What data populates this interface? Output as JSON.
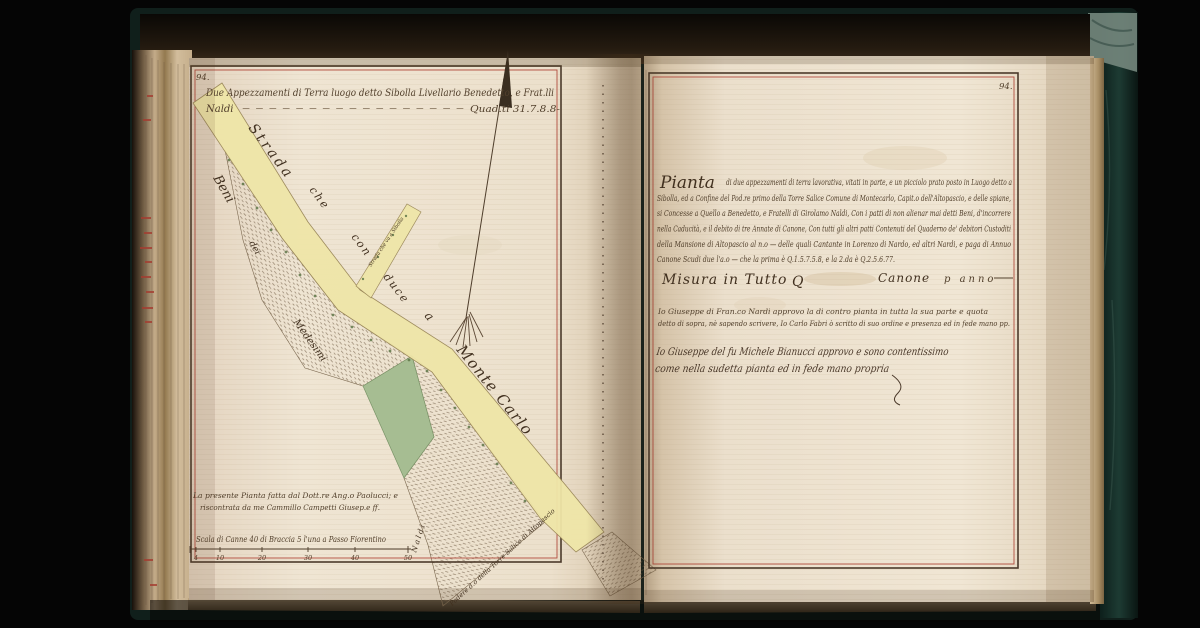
{
  "left_page": {
    "page_number": "94.",
    "header_line1": "Due Appezzamenti di Terra luogo detto Sibolla Livellario Benedetto, e Frat.lli",
    "header_naldi": "Naldi",
    "header_dashes": "– – – – – – – – – – – – – – – – –",
    "header_quantity": "Quad.ti 31.7.8.8-",
    "map": {
      "road_words": [
        "Strada",
        "che",
        "con",
        "duce",
        "a",
        "Monte Carlo"
      ],
      "spur_label": "Strada che va a Sibolla",
      "parcel_words": [
        "Beni",
        "dei",
        "Medesimi"
      ],
      "side_owner_label": "Naldi",
      "podere_label": "Podere d.o della Torre Salice di Altopascio",
      "credit_line1": "La presente Pianta fatta dal Dott.re Ang.o Paolucci; e",
      "credit_line2": "riscontrata da me Cammillo Campetti Giusep.e ff.",
      "scale_caption": "Scala di Canne 40 di Braccia 5 l'una a Passo Fiorentino",
      "scale_ticks": [
        "4",
        "10",
        "20",
        "30",
        "40",
        "50"
      ]
    }
  },
  "right_page": {
    "page_number": "94.",
    "lead_word": "Pianta",
    "line1_rest": "di due appezzamenti di terra lavorativa, vitati in parte, e un picciolo prato posto in Luogo detto a",
    "line2": "Sibolla, ed a Confine del Pod.re primo della Torre Salice Comune di Montecarlo, Capit.o dell'Altopascio, e delle spiane,",
    "line3": "si Concesse a Quello a Benedetto, e Fratelli di Girolamo Naldi, Con i patti di non alienar mai detti Beni, d'incorrere",
    "line4": "nella Caducità, e il debito di tre Annate di Canone, Con tutti gli altri patti Contenuti del Quaderno de' debitori Custoditi",
    "line5": "della Mansione di Altopascio al n.o — delle quali Cantante in Lorenzo di Nardo, ed altri Nardi, e paga di Annuo",
    "line6": "Canone Scudi due l'a.o — che la prima è Q.1.5.7.5.8, e la 2.da è Q.2.5.6.77.",
    "misura_label": "Misura in Tutto",
    "misura_q": "Q",
    "canone_label": "Canone",
    "canone_suffix": "p anno",
    "attest1_line1": "Io Giuseppe di Fran.co Nardi approvo la di contro pianta in tutta la sua parte e quota",
    "attest1_line2": "detto di sopra, nè sapendo scrivere, Io Carlo Fabri ò scritto di suo ordine e presenza ed in fede mano pp.",
    "attest2_line1": "Io Giuseppe del fu Michele Bianucci approvo e sono contentissimo",
    "attest2_line2": "come nella sudetta pianta ed in fede mano propria"
  },
  "colors": {
    "paper": "#eee3d1",
    "ink": "#52402c",
    "frame_red": "#b24c3e",
    "road_yellow": "#efe6a8",
    "meadow_green": "#a6bd92",
    "cover_teal": "#1a332e",
    "edge_red_marks": "#a43c30"
  }
}
